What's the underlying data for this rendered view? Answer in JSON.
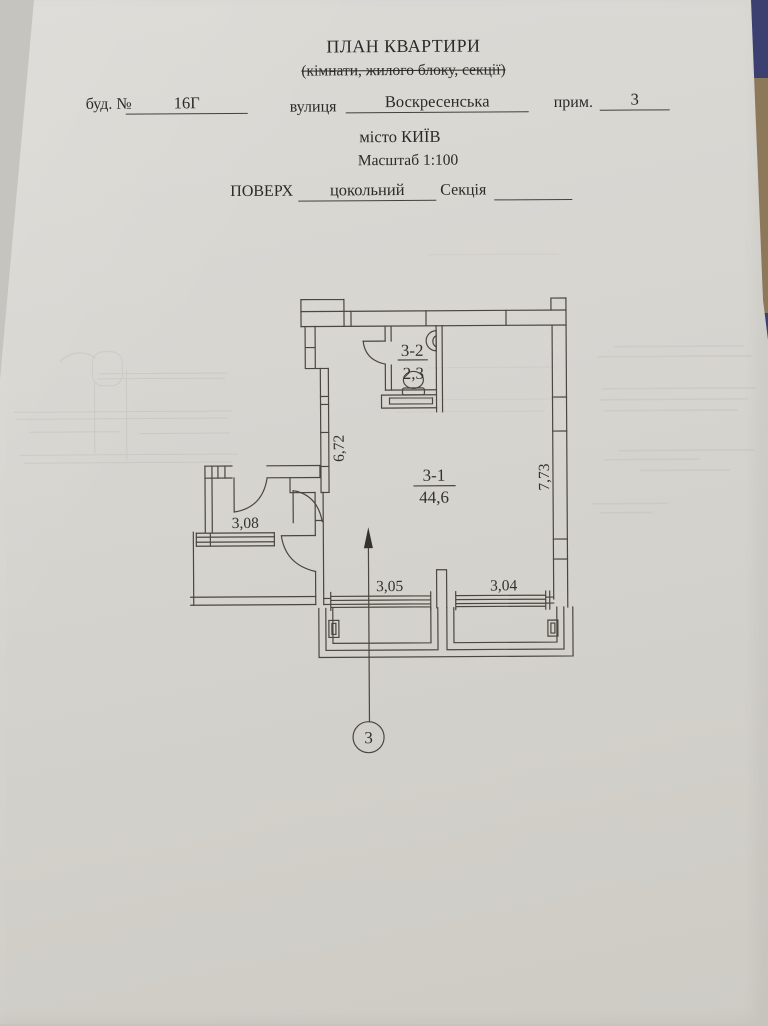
{
  "header": {
    "title": "ПЛАН КВАРТИРИ",
    "subtitle": "(кімнати, жилого блоку, секції)",
    "building_label": "буд. №",
    "building_value": "16Г",
    "street_label": "вулиця",
    "street_value": "Воскресенська",
    "apartment_label": "прим.",
    "apartment_value": "3",
    "city": "місто КИЇВ",
    "scale": "Масштаб 1:100",
    "floor_label": "ПОВЕРХ",
    "floor_value": "цокольний",
    "section_label": "Секція",
    "section_value": ""
  },
  "plan": {
    "main_room_id": "3-1",
    "main_room_area": "44,6",
    "bathroom_id": "3-2",
    "bathroom_area": "2,3",
    "dim_left_wall": "6,72",
    "dim_right_wall": "7,73",
    "dim_hallway": "3,08",
    "dim_window_1": "3,05",
    "dim_window_2": "3,04",
    "section_marker": "3"
  },
  "colors": {
    "paper": "#d8d6d1",
    "ink": "#4a4640",
    "text": "#2b2a28",
    "table_navy": "#3c4070",
    "table_edge_brown": "#8d785a"
  }
}
